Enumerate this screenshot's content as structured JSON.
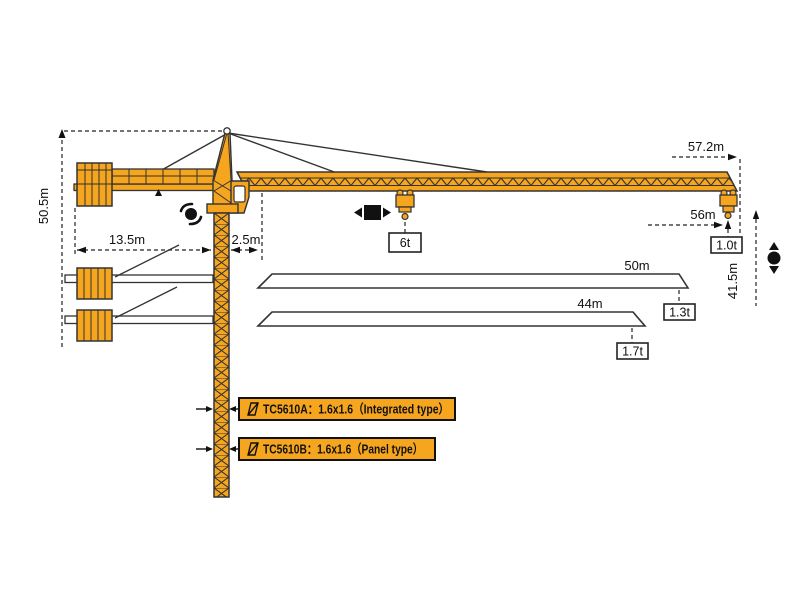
{
  "diagram_title": "TC5610 tower crane working range diagram",
  "colors": {
    "crane_orange": "#F6A51F",
    "line_dark": "#2e2e2e",
    "icon_black": "#111111",
    "background": "#ffffff"
  },
  "dimensions": {
    "total_height": "50.5m",
    "counter_jib_length": "13.5m",
    "rear_offset": "2.5m",
    "max_radius": "57.2m",
    "hook_radius": "56m",
    "hook_height": "41.5m",
    "jib_option_50": "50m",
    "jib_option_44": "44m"
  },
  "loads": {
    "mid_trolley": "6t",
    "tip_56m": "1.0t",
    "tip_50m": "1.3t",
    "tip_44m": "1.7t"
  },
  "models": {
    "type_a": "TC5610A：1.6x1.6（Integrated type）",
    "type_b": "TC5610B：1.6x1.6（Panel type）"
  },
  "icons": {
    "slew": "slew-rotation-icon",
    "trolley": "trolley-travel-icon",
    "hoist": "hoist-up-down-icon"
  }
}
